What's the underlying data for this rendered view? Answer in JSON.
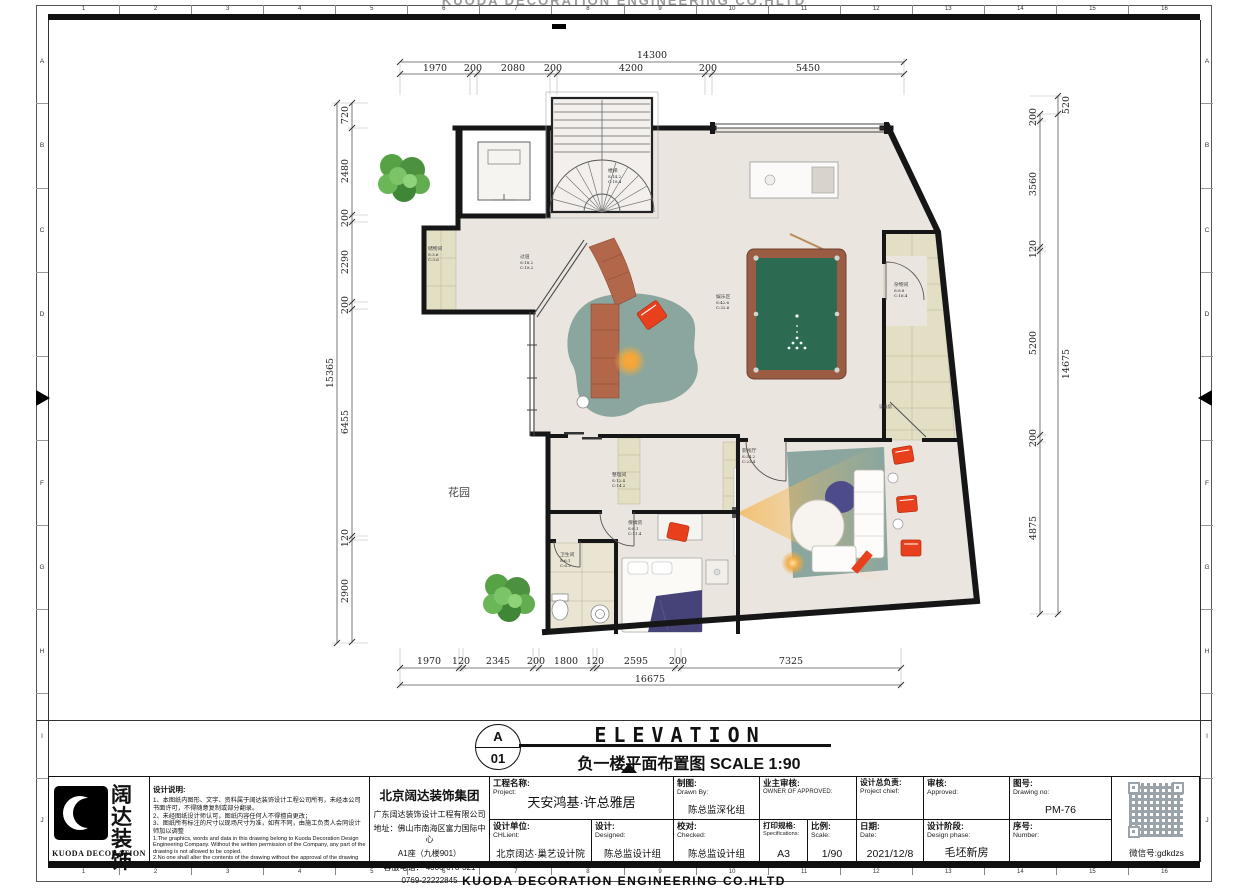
{
  "page": {
    "top_watermark": "KUODA DECORATION ENGINEERING CO.HLTD",
    "bottom_company": "KUODA DECORATION ENGINEERING  CO.HLTD"
  },
  "ruler": {
    "cols": [
      "1",
      "2",
      "3",
      "4",
      "5",
      "6",
      "7",
      "8",
      "9",
      "10",
      "11",
      "12",
      "13",
      "14",
      "15",
      "16"
    ],
    "rows": [
      "A",
      "B",
      "C",
      "D",
      "E",
      "F",
      "G",
      "H",
      "I",
      "J"
    ]
  },
  "title": {
    "detail_letter": "A",
    "detail_number": "01",
    "name_en": "ELEVATION",
    "name_cn": "负一楼平面布置图",
    "scale_text": "SCALE 1:90"
  },
  "dims": {
    "top": {
      "overall": "14300",
      "segments": [
        "1970",
        "200",
        "2080",
        "200",
        "4200",
        "200",
        "5450"
      ]
    },
    "bottom": {
      "overall": "16675",
      "segments": [
        "1970",
        "120",
        "2345",
        "200",
        "1800",
        "120",
        "2595",
        "200",
        "7325"
      ]
    },
    "left": {
      "overall": "15365",
      "segments": [
        "720",
        "2480",
        "200",
        "2290",
        "200",
        "6455",
        "120",
        "2900"
      ]
    },
    "right": {
      "overall": "14675",
      "outer_top": "520",
      "segments": [
        "200",
        "3560",
        "120",
        "5200",
        "200",
        "4875"
      ]
    }
  },
  "rooms": [
    {
      "name": "楼梯",
      "s": "S:14.2",
      "c": "C:18.4"
    },
    {
      "name": "储物间",
      "s": "S:3.6",
      "c": "C:3.6"
    },
    {
      "name": "过道",
      "s": "S:18.2",
      "c": "C:18.2"
    },
    {
      "name": "娱乐区",
      "s": "S:42.6",
      "c": "C:32.6"
    },
    {
      "name": "杂物间",
      "s": "S:8.8",
      "c": "C:16.4"
    },
    {
      "name": "设备房",
      "s": "",
      "c": ""
    },
    {
      "name": "影视厅",
      "s": "S:34.2",
      "c": "C:23.4"
    },
    {
      "name": "整理间",
      "s": "S:12.4",
      "c": "C:14.2"
    },
    {
      "name": "保姆房",
      "s": "S:8.1",
      "c": "C:11.4"
    },
    {
      "name": "卫生间",
      "s": "S:6.1",
      "c": "C:6.2"
    }
  ],
  "garden_label": "花园",
  "titleblock": {
    "logo": {
      "cn_line1": "阔达",
      "cn_line2": "装饰",
      "en": "KUODA  DECORATION"
    },
    "notes": {
      "heading": "设计说明:",
      "cn1": "1、本图纸内图形、文字、资料属于阔达装饰设计工程公司所有，未经本公司 书面许可，不得随意复制或部分翻录。",
      "cn2": "2、未经图纸设计师认可，图纸内容任何人不得擅自更改；",
      "cn3": "3、图纸所有标注的尺寸以现场尺寸为准，如有不同，由施工负责人会同设计 师加以调整",
      "en1": "1.The graphics, words and data in this drawing belong to Kuoda Decoration Design Engineering Company. Without the written permission of the Company, any part of the drawing is not allowed to be copied.",
      "en2": "2.No one shall alter the contents of the drawing without the approval of the drawing designer;",
      "en3": "3.All dimensions marked in the drawings shall be subject to the site dimensions. If there is any discrepancy, the construction leader shall make adjustments together with the designer."
    },
    "company": {
      "group": "北京阔达装饰集团",
      "sub": "广东阔达装饰设计工程有限公司",
      "addr1": "地址：佛山市南海区富力国际中心",
      "addr2": "A1座（九楼901）",
      "tel1": "客服电话： 4006-678-321",
      "tel2": "0769-22222845"
    },
    "fields": {
      "project": {
        "cn": "工程名称:",
        "en": "Project:",
        "value": "天安鸿基·许总雅居"
      },
      "design_unit": {
        "cn": "设计单位:",
        "en": "CHLient:",
        "value": "北京阔达·巢艺设计院"
      },
      "designed": {
        "cn": "设计:",
        "en": "Designed:",
        "value": "陈总监设计组"
      },
      "drawn": {
        "cn": "制图:",
        "en": "Drawn By:",
        "value": "陈总监深化组"
      },
      "checked": {
        "cn": "校对:",
        "en": "Checked:",
        "value": "陈总监设计组"
      },
      "owner": {
        "cn": "业主审核:",
        "en": "OWNER OF APPROVED:",
        "value": ""
      },
      "spec": {
        "cn": "打印规格:",
        "en": "Specifications:",
        "value": "A3"
      },
      "scale": {
        "cn": "比例:",
        "en": "Scale:",
        "value": "1/90"
      },
      "chief": {
        "cn": "设计总负责:",
        "en": "Project chief:",
        "value": ""
      },
      "date": {
        "cn": "日期:",
        "en": "Date:",
        "value": "2021/12/8"
      },
      "approved": {
        "cn": "审核:",
        "en": "Approved:",
        "value": ""
      },
      "phase": {
        "cn": "设计阶段:",
        "en": "Design phase:",
        "value": "毛坯新房"
      },
      "drawing_no": {
        "cn": "图号:",
        "en": "Drawing no:",
        "value": "PM-76"
      },
      "number": {
        "cn": "序号:",
        "en": "Number:",
        "value": ""
      }
    },
    "wechat": "微信号:gdkdzs"
  },
  "colors": {
    "wall": "#161616",
    "floor": "#ebe5e0",
    "tile": "#e3dfc4",
    "rug": "#8aa69e",
    "billiard_green": "#2d6a52",
    "sofa_terracotta": "#b2664a",
    "accent_red": "#e8401d",
    "accent_purple": "#4e4b8b",
    "tree_green": "#5ea84b",
    "glow_orange": "#f2a93b"
  }
}
